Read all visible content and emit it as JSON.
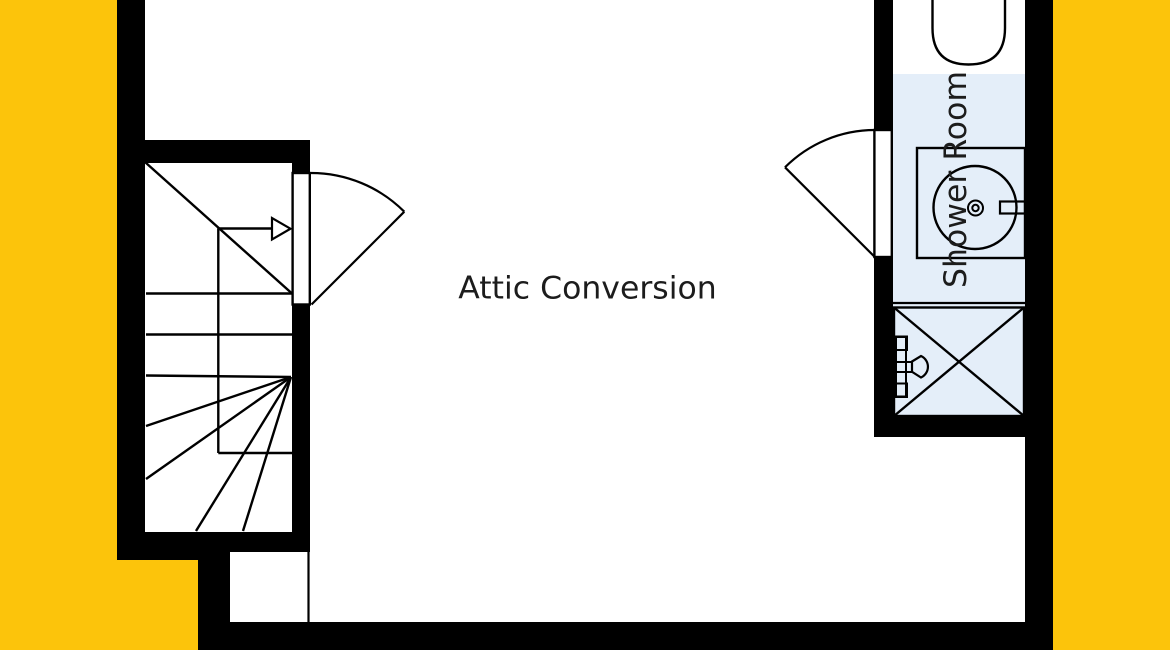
{
  "plan": {
    "room_labels": {
      "attic": "Attic Conversion",
      "shower": "Shower Room"
    }
  },
  "colors": {
    "paper": "#FFFFFF",
    "margin_yellow": "#FCC40B",
    "wall": "#000000",
    "line": "#000000",
    "shower_floor": "#E4EEF9",
    "door_leaf": "#FFFFFF",
    "text": "#1C1C1C"
  }
}
